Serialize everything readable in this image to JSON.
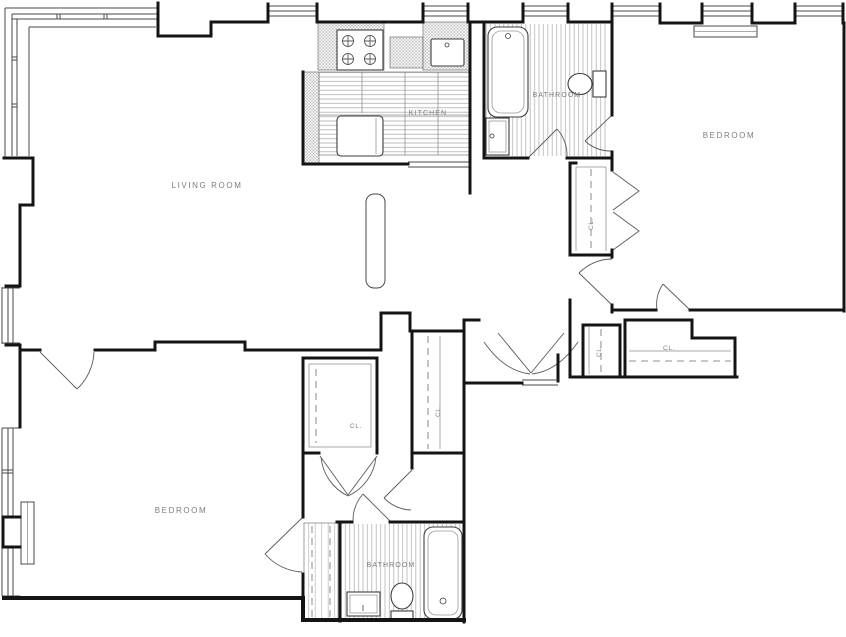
{
  "plan": {
    "labels": {
      "living_room": "LIVING ROOM",
      "kitchen": "KITCHEN",
      "bathroom_top": "BATHROOM",
      "bedroom_top_right": "BEDROOM",
      "bedroom_bottom_left": "BEDROOM",
      "bathroom_bottom": "BATHROOM",
      "closet_bedroom1": "CL.",
      "closet_hall_small": "CL.",
      "closet_hall_wide": "CL.",
      "closet_bedroom2_walkin": "CL.",
      "closet_hall_tall": "CL."
    },
    "colors": {
      "wall": "#141414",
      "line": "#4a4a4a",
      "lightline": "#8c8c8c",
      "hatch": "#8f8f8f",
      "text": "#7d7d7d",
      "background": "#ffffff"
    }
  }
}
